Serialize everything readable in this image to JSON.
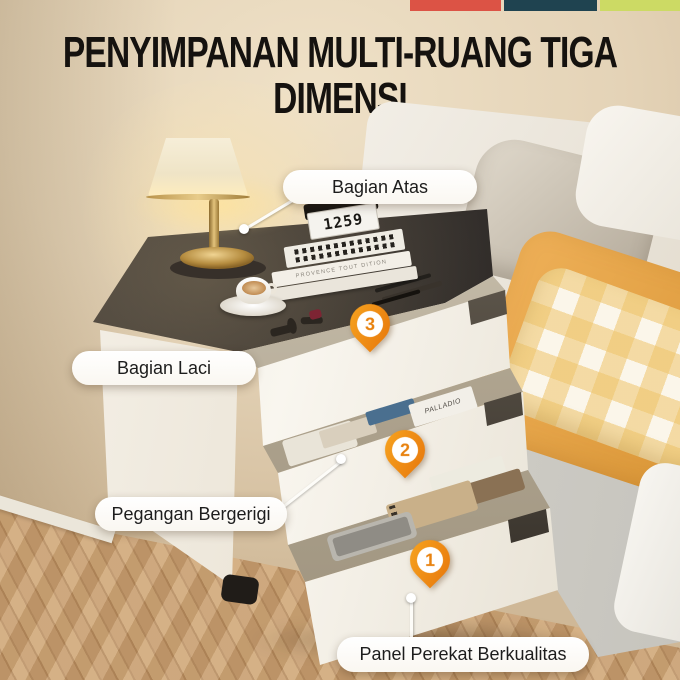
{
  "header": {
    "title_line1": "PENYIMPANAN MULTI-RUANG TIGA",
    "title_line2": "DIMENSI",
    "bar_colors": [
      "#dc5345",
      "#1f4350",
      "#ccda64"
    ]
  },
  "callouts": [
    {
      "label": "Bagian Atas"
    },
    {
      "label": "Bagian Laci"
    },
    {
      "label": "Pegangan Bergerigi"
    },
    {
      "label": "Panel Perekat Berkualitas"
    }
  ],
  "pins": [
    {
      "number": "3"
    },
    {
      "number": "2"
    },
    {
      "number": "1"
    }
  ],
  "pin_color": "#ee8612",
  "scene": {
    "clock_time": "1259",
    "book_spine_text": "PROVENCE TOUT DITION",
    "drawer_book_text": "PALLADIO",
    "wall_color": "#e3d2b6",
    "tabletop_color": "#38332e",
    "cabinet_color": "#f4efe6",
    "blanket_color": "#e8a74b",
    "gingham_color": "#eec46a",
    "floor_color": "#c59c6e"
  }
}
